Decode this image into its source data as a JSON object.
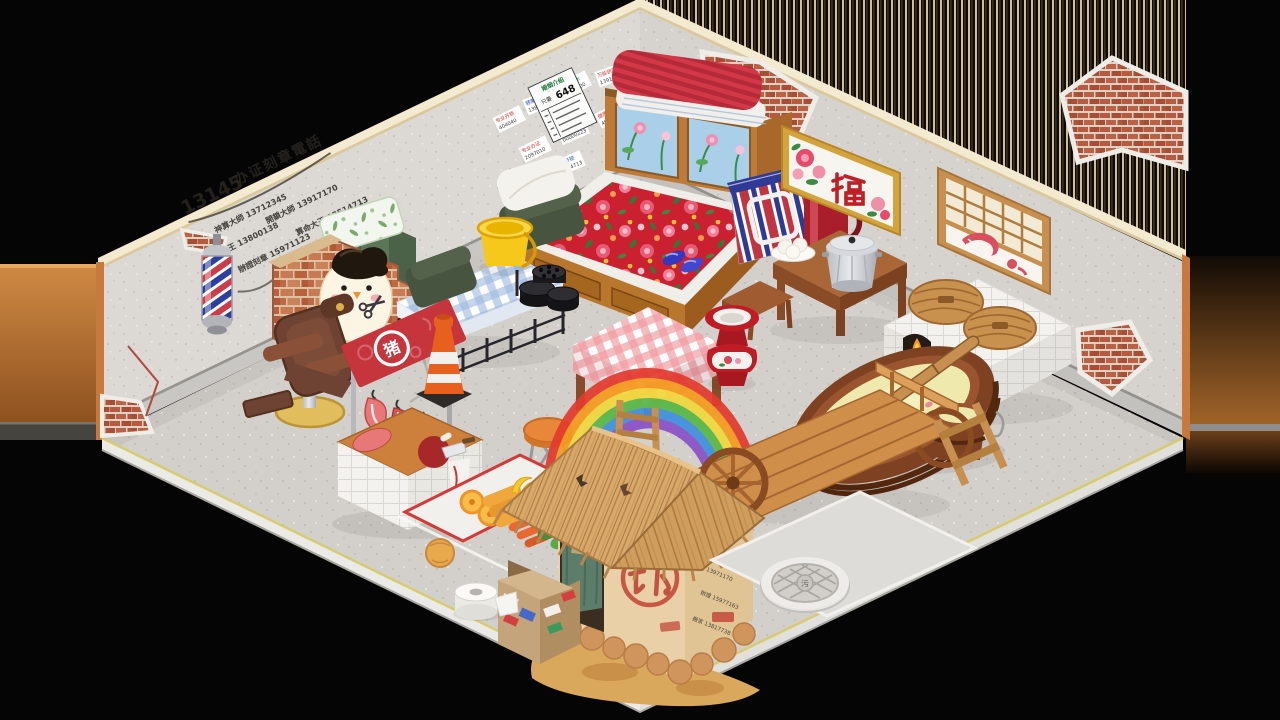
{
  "colors": {
    "wall": "#dcd9d4",
    "floor": "#d3d0cb",
    "trim": "#f4ead0",
    "wall-edge": "#c87a3e",
    "banner-red": "#c6353c",
    "fu-red": "#c01f26",
    "quilt-red": "#cb2030",
    "gingham-blue": "#9db9dd",
    "gingham-pink": "#f0989f",
    "locker-green": "#5c7659",
    "bucket-yellow": "#f6c81c",
    "water-yellow": "#efe9ae",
    "cone-orange": "#e8601e",
    "thatch": "#d8a96a",
    "rb-red": "#e33a2e",
    "rb-orange": "#f59a1e",
    "rb-yellow": "#f2d93c",
    "rb-green": "#58b847",
    "rb-blue": "#3f8fdf",
    "rb-violet": "#8a4fc8"
  },
  "wall": {
    "graffiti": {
      "headline_num": "13145",
      "headline_suffix": "办证刻章電話",
      "lines": [
        "神算大師 13712345",
        "疏通大王 13800138",
        "開鎖大師 13917170",
        "辦證刻章 15971123",
        "算命大王 13514713"
      ]
    },
    "poster": {
      "title": "婚姻介绍",
      "price_prefix": "只要",
      "price": "648"
    },
    "ads": [
      {
        "t": "专业开锁",
        "n": "404040"
      },
      {
        "t": "健康大王",
        "n": "13800138000"
      },
      {
        "t": "疏通下水",
        "n": "7792800"
      },
      {
        "t": "万能钥匙",
        "n": "13917170"
      },
      {
        "t": "专业办证",
        "n": "2097010"
      },
      {
        "t": "通厕大王",
        "n": "00000223"
      },
      {
        "t": "健康大王",
        "n": "40400456"
      },
      {
        "t": "专业开锁",
        "n": "13514713"
      },
      {
        "t": "万能疏通",
        "n": "15977163"
      },
      {
        "t": "专业刻章",
        "n": "13712345"
      }
    ]
  },
  "hut": {
    "wc": "W.C",
    "ads": [
      "疏通 13971170",
      "辦證 15977163",
      "搬家 13817738"
    ]
  },
  "icons": {
    "pig_badge": "猪",
    "fu_character": "福",
    "chai_character": "拆",
    "manhole_mark": "污",
    "scissors": "✂"
  }
}
